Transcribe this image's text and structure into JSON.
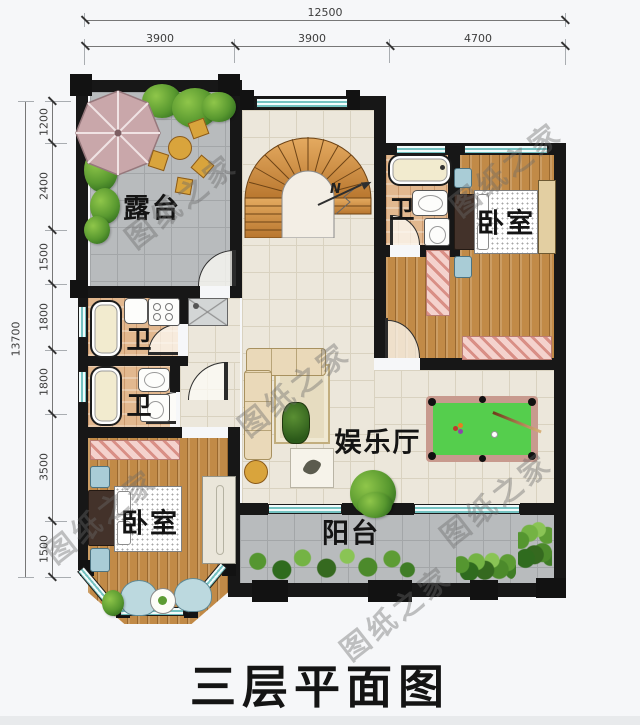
{
  "title": "三层平面图",
  "watermark": "图纸之家",
  "compass_label": "N",
  "dimensions": {
    "top": {
      "total": "12500",
      "segments": [
        "3900",
        "3900",
        "4700"
      ]
    },
    "left": {
      "total": "13700",
      "segments": [
        "1200",
        "2400",
        "1500",
        "1800",
        "1800",
        "3500",
        "1500"
      ]
    }
  },
  "rooms": {
    "terrace": {
      "label": "露台"
    },
    "bathroom_upper_right": {
      "label": "卫"
    },
    "bedroom_upper_right": {
      "label": "卧室"
    },
    "bathroom_left_upper": {
      "label": "卫"
    },
    "bathroom_left_lower": {
      "label": "卫"
    },
    "bedroom_lower_left": {
      "label": "卧室"
    },
    "entertainment_hall": {
      "label": "娱乐厅"
    },
    "balcony": {
      "label": "阳台"
    }
  },
  "colors": {
    "wall": "#171717",
    "wood_floor": "#c18a47",
    "cream_tile": "#ece7db",
    "gray_tile": "#b8bbbd",
    "bath_tile": "#e2b88f",
    "window_teal": "#74c2c1",
    "pool_felt": "#55ce4d",
    "pool_rail": "#c89a8e",
    "rug_pink": "#f0c4bf",
    "umbrella_pink": "#c9a7aa",
    "stair_wood": "#d79a4f",
    "plant_green": "#58982f"
  }
}
